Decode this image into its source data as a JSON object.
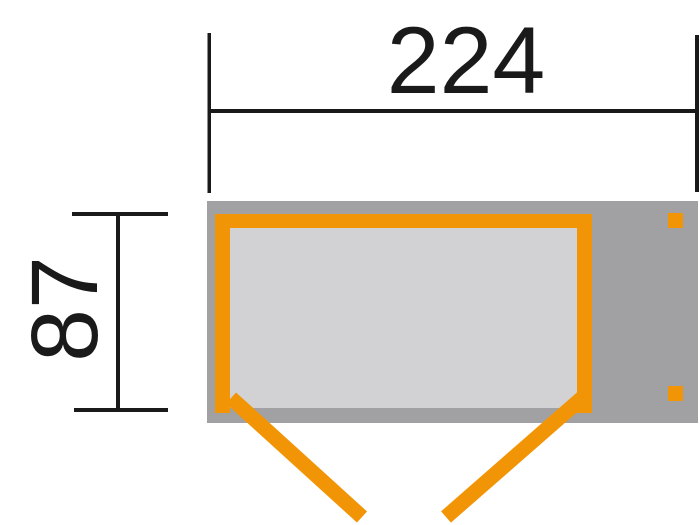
{
  "diagram": {
    "type": "garden-house-floor-plan-top-view",
    "dimensions": {
      "width_label": "224",
      "depth_label": "87"
    },
    "colors": {
      "accent_orange": "#F19506",
      "wall_zone_gray": "#A1A1A3",
      "interior_gray": "#D2D2D4",
      "dimension_black": "#1A1A1A",
      "background": "#FFFFFF"
    }
  }
}
